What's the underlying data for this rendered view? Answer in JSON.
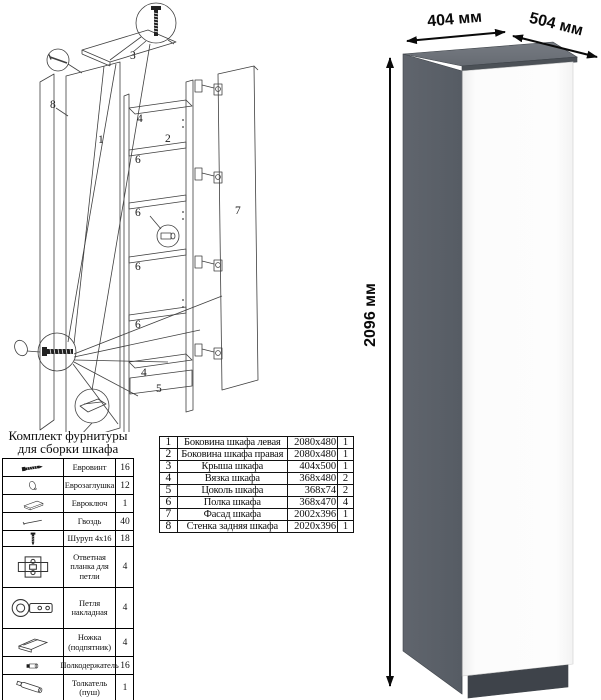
{
  "hardware": {
    "title_line1": "Комплект фурнитуры",
    "title_line2": "для сборки шкафа",
    "items": [
      {
        "icon": "confirmat-screw-icon",
        "name": "Евровинт",
        "qty": "16"
      },
      {
        "icon": "cap-icon",
        "name": "Еврозаглушка",
        "qty": "12"
      },
      {
        "icon": "hex-key-icon",
        "name": "Евроключ",
        "qty": "1"
      },
      {
        "icon": "nail-icon",
        "name": "Гвоздь",
        "qty": "40"
      },
      {
        "icon": "wood-screw-icon",
        "name": "Шуруп 4x16",
        "qty": "18"
      },
      {
        "icon": "mounting-plate-icon",
        "name": "Ответная планка для петли",
        "qty": "4"
      },
      {
        "icon": "hinge-icon",
        "name": "Петля накладная",
        "qty": "4"
      },
      {
        "icon": "foot-icon",
        "name": "Ножка (подпятник)",
        "qty": "4"
      },
      {
        "icon": "shelf-support-icon",
        "name": "Полкодержатель",
        "qty": "16"
      },
      {
        "icon": "push-opener-icon",
        "name": "Толкатель (пуш)",
        "qty": "1"
      }
    ]
  },
  "parts": {
    "rows": [
      {
        "num": "1",
        "name": "Боковина шкафа левая",
        "size": "2080x480",
        "qty": "1"
      },
      {
        "num": "2",
        "name": "Боковина шкафа правая",
        "size": "2080x480",
        "qty": "1"
      },
      {
        "num": "3",
        "name": "Крыша шкафа",
        "size": "404x500",
        "qty": "1"
      },
      {
        "num": "4",
        "name": "Вязка шкафа",
        "size": "368x480",
        "qty": "2"
      },
      {
        "num": "5",
        "name": "Цоколь шкафа",
        "size": "368x74",
        "qty": "2"
      },
      {
        "num": "6",
        "name": "Полка шкафа",
        "size": "368x470",
        "qty": "4"
      },
      {
        "num": "7",
        "name": "Фасад шкафа",
        "size": "2002x396",
        "qty": "1"
      },
      {
        "num": "8",
        "name": "Стенка задняя шкафа",
        "size": "2020x396",
        "qty": "1"
      }
    ]
  },
  "diagram": {
    "labels": {
      "n1": "1",
      "n2": "2",
      "n3": "3",
      "n4": "4",
      "n5": "5",
      "n6": "6",
      "n7": "7",
      "n8": "8"
    }
  },
  "product": {
    "width_label": "404 мм",
    "depth_label": "504 мм",
    "height_label": "2096 мм",
    "colors": {
      "side": "#5b6169",
      "top": "#6e737a",
      "door": "#fbfbfb",
      "plinth": "#3e434a",
      "edge": "#3f444a"
    }
  }
}
